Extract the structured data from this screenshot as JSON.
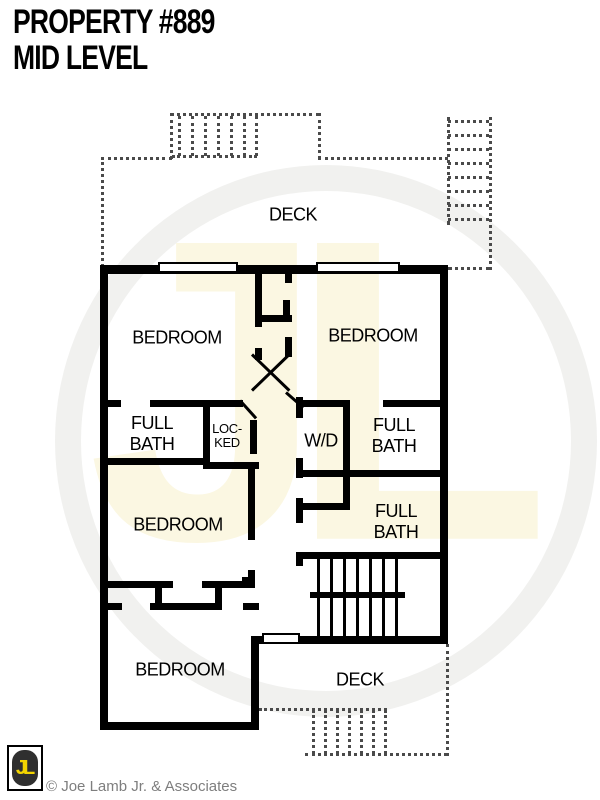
{
  "header": {
    "title_line1": "PROPERTY #889",
    "title_line2": "MID LEVEL"
  },
  "plan": {
    "deck_top_label": "DECK",
    "deck_bottom_label": "DECK",
    "bedroom_top_left_label": "BEDROOM",
    "bedroom_top_right_label": "BEDROOM",
    "bedroom_middle_label": "BEDROOM",
    "bedroom_bottom_label": "BEDROOM",
    "bath_left": {
      "line1": "FULL",
      "line2": "BATH"
    },
    "bath_right_upper": {
      "line1": "FULL",
      "line2": "BATH"
    },
    "bath_right_lower": {
      "line1": "FULL",
      "line2": "BATH"
    },
    "locked_closet": {
      "line1": "LOC-",
      "line2": "KED"
    },
    "washer_dryer_label": "W/D"
  },
  "watermark": {
    "monogram": "JL"
  },
  "footer": {
    "logo_monogram": "JL",
    "copyright": "© Joe Lamb Jr. & Associates"
  },
  "colors": {
    "wall": "#000000",
    "logo_yellow": "#f2d400",
    "logo_dark": "#2f2f2f",
    "copyright_gray": "#7e7e7e",
    "watermark_cream": "#fbf7e2",
    "watermark_gray": "#f1f1ef"
  }
}
